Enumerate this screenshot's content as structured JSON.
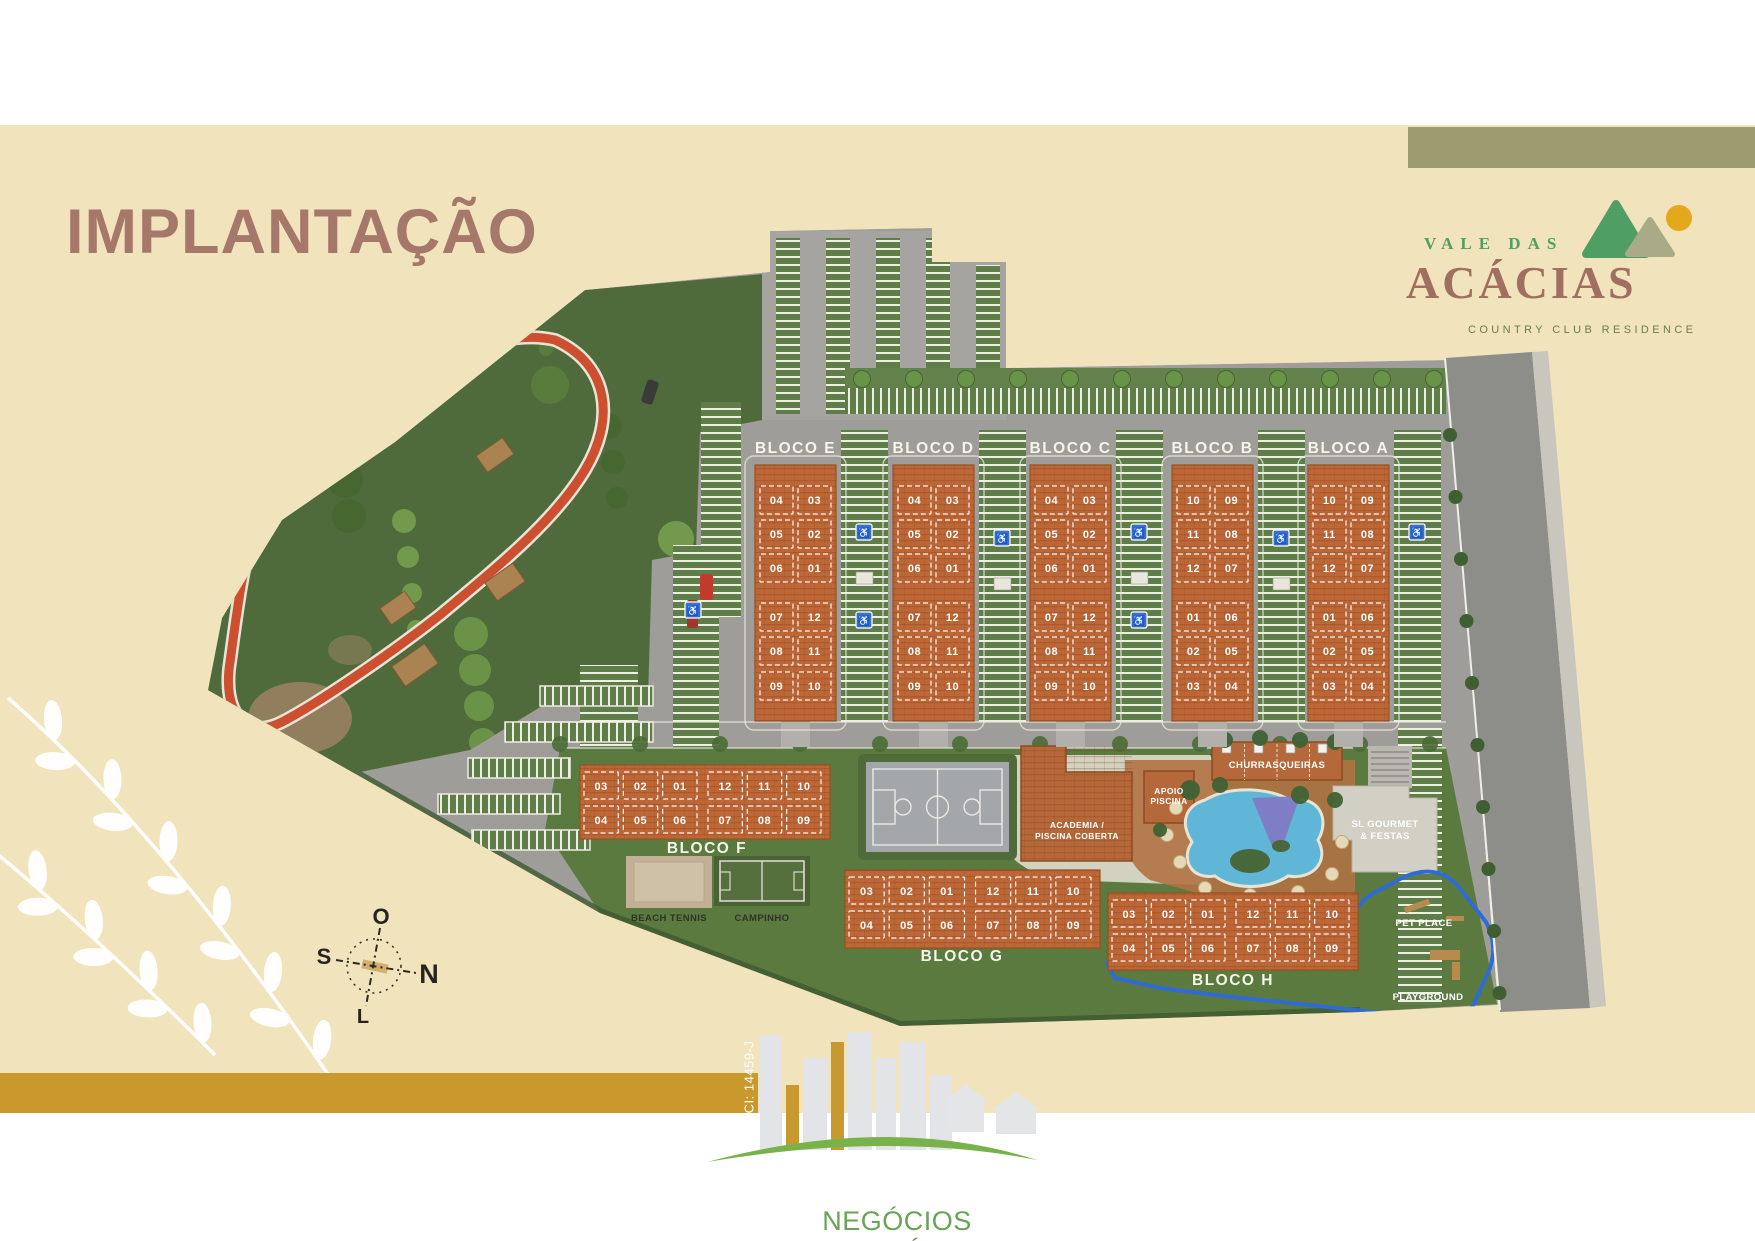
{
  "page": {
    "title": "IMPLANTAÇÃO"
  },
  "brand": {
    "top": "VALE DAS",
    "main": "ACÁCIAS",
    "tagline": "COUNTRY CLUB RESIDENCE"
  },
  "compass": {
    "west": "O",
    "south": "S",
    "north": "N",
    "east": "L"
  },
  "footer": {
    "registration": "CI: 14459-J",
    "tagline": "NEGÓCIOS IMOBILIÁRIOS"
  },
  "plan": {
    "blocks_vertical": [
      {
        "id": "E",
        "label": "BLOCO E",
        "units_top": [
          [
            "04",
            "03"
          ],
          [
            "05",
            "02"
          ],
          [
            "06",
            "01"
          ]
        ],
        "units_bottom": [
          [
            "07",
            "12"
          ],
          [
            "08",
            "11"
          ],
          [
            "09",
            "10"
          ]
        ]
      },
      {
        "id": "D",
        "label": "BLOCO D",
        "units_top": [
          [
            "04",
            "03"
          ],
          [
            "05",
            "02"
          ],
          [
            "06",
            "01"
          ]
        ],
        "units_bottom": [
          [
            "07",
            "12"
          ],
          [
            "08",
            "11"
          ],
          [
            "09",
            "10"
          ]
        ]
      },
      {
        "id": "C",
        "label": "BLOCO C",
        "units_top": [
          [
            "04",
            "03"
          ],
          [
            "05",
            "02"
          ],
          [
            "06",
            "01"
          ]
        ],
        "units_bottom": [
          [
            "07",
            "12"
          ],
          [
            "08",
            "11"
          ],
          [
            "09",
            "10"
          ]
        ]
      },
      {
        "id": "B",
        "label": "BLOCO B",
        "units_top": [
          [
            "10",
            "09"
          ],
          [
            "11",
            "08"
          ],
          [
            "12",
            "07"
          ]
        ],
        "units_bottom": [
          [
            "01",
            "06"
          ],
          [
            "02",
            "05"
          ],
          [
            "03",
            "04"
          ]
        ]
      },
      {
        "id": "A",
        "label": "BLOCO A",
        "units_top": [
          [
            "10",
            "09"
          ],
          [
            "11",
            "08"
          ],
          [
            "12",
            "07"
          ]
        ],
        "units_bottom": [
          [
            "01",
            "06"
          ],
          [
            "02",
            "05"
          ],
          [
            "03",
            "04"
          ]
        ]
      }
    ],
    "blocks_horizontal": [
      {
        "id": "F",
        "label": "BLOCO F",
        "units_rows": [
          [
            "03",
            "02",
            "01",
            "12",
            "11",
            "10"
          ],
          [
            "04",
            "05",
            "06",
            "07",
            "08",
            "09"
          ]
        ]
      },
      {
        "id": "G",
        "label": "BLOCO G",
        "units_rows": [
          [
            "03",
            "02",
            "01",
            "12",
            "11",
            "10"
          ],
          [
            "04",
            "05",
            "06",
            "07",
            "08",
            "09"
          ]
        ]
      },
      {
        "id": "H",
        "label": "BLOCO H",
        "units_rows": [
          [
            "03",
            "02",
            "01",
            "12",
            "11",
            "10"
          ],
          [
            "04",
            "05",
            "06",
            "07",
            "08",
            "09"
          ]
        ]
      }
    ],
    "amenities": {
      "academia": [
        "ACADEMIA /",
        "PISCINA COBERTA"
      ],
      "apoio": [
        "APOIO",
        "PISCINA"
      ],
      "churrasqueiras": "CHURRASQUEIRAS",
      "gourmet": [
        "SL GOURMET",
        "& FESTAS"
      ],
      "beach_tennis": "BEACH TENNIS",
      "campinho": "CAMPINHO",
      "pet_place": "PET PLACE",
      "playground": "PLAYGROUND"
    }
  },
  "colors": {
    "cream": "#f1e3bc",
    "khaki_band": "#9b9b6e",
    "gold_band": "#c9992b",
    "title": "#a5786a",
    "brand_green": "#4f9e63",
    "brand_olive": "#6d7b4e",
    "building_orange": "#bd6737",
    "track_red": "#cc5030",
    "pool_blue": "#5fb6d6",
    "footer_green": "#68a356"
  }
}
